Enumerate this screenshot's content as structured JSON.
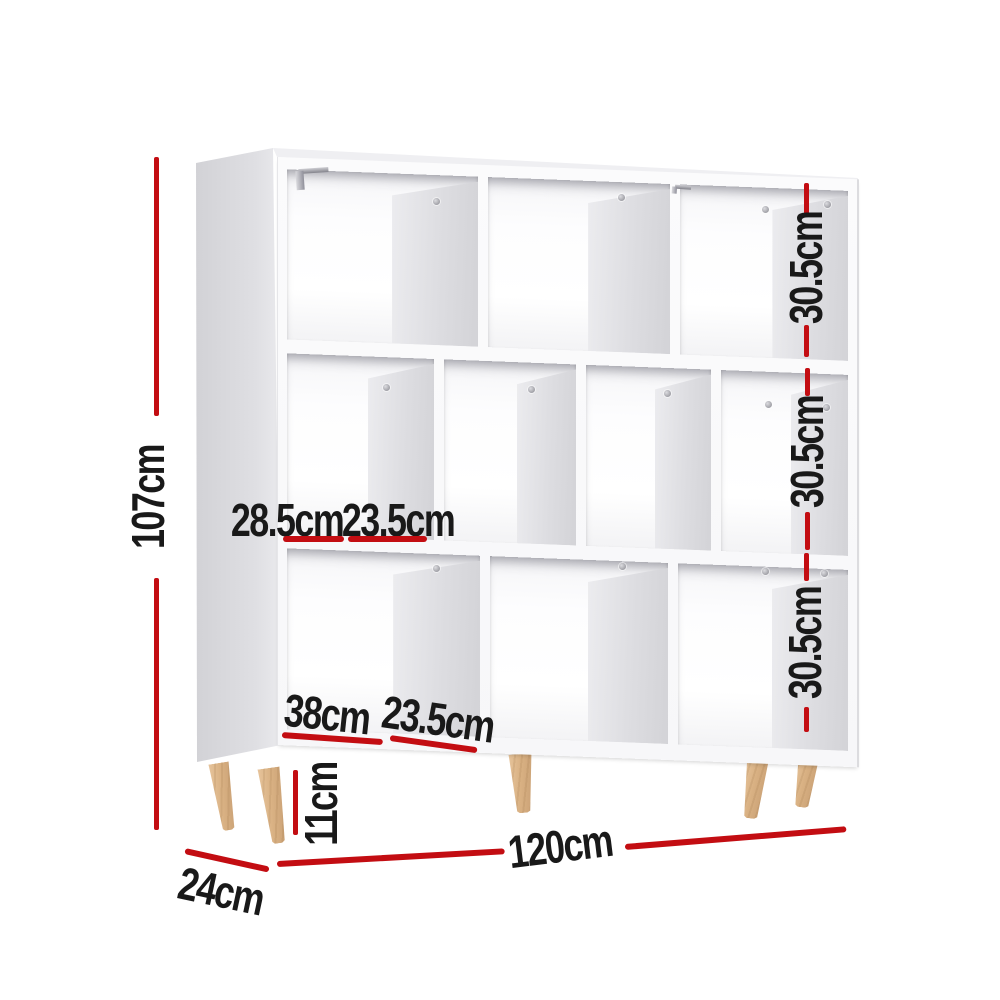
{
  "subject": "white staggered-cube bookshelf with wooden legs",
  "dims": {
    "height": "107cm",
    "width": "120cm",
    "depth": "24cm",
    "leg_height": "11cm",
    "shelf_heights": [
      "30.5cm",
      "30.5cm",
      "30.5cm"
    ],
    "middle_row_widths": [
      "28.5cm",
      "23.5cm"
    ],
    "bottom_row_widths": [
      "38cm",
      "23.5cm"
    ]
  },
  "colors": {
    "dimension_red": "#c30d12",
    "label_text": "#191919",
    "wood_leg": "#d9b183",
    "cabinet_side_gray": "#d6d6d9"
  }
}
